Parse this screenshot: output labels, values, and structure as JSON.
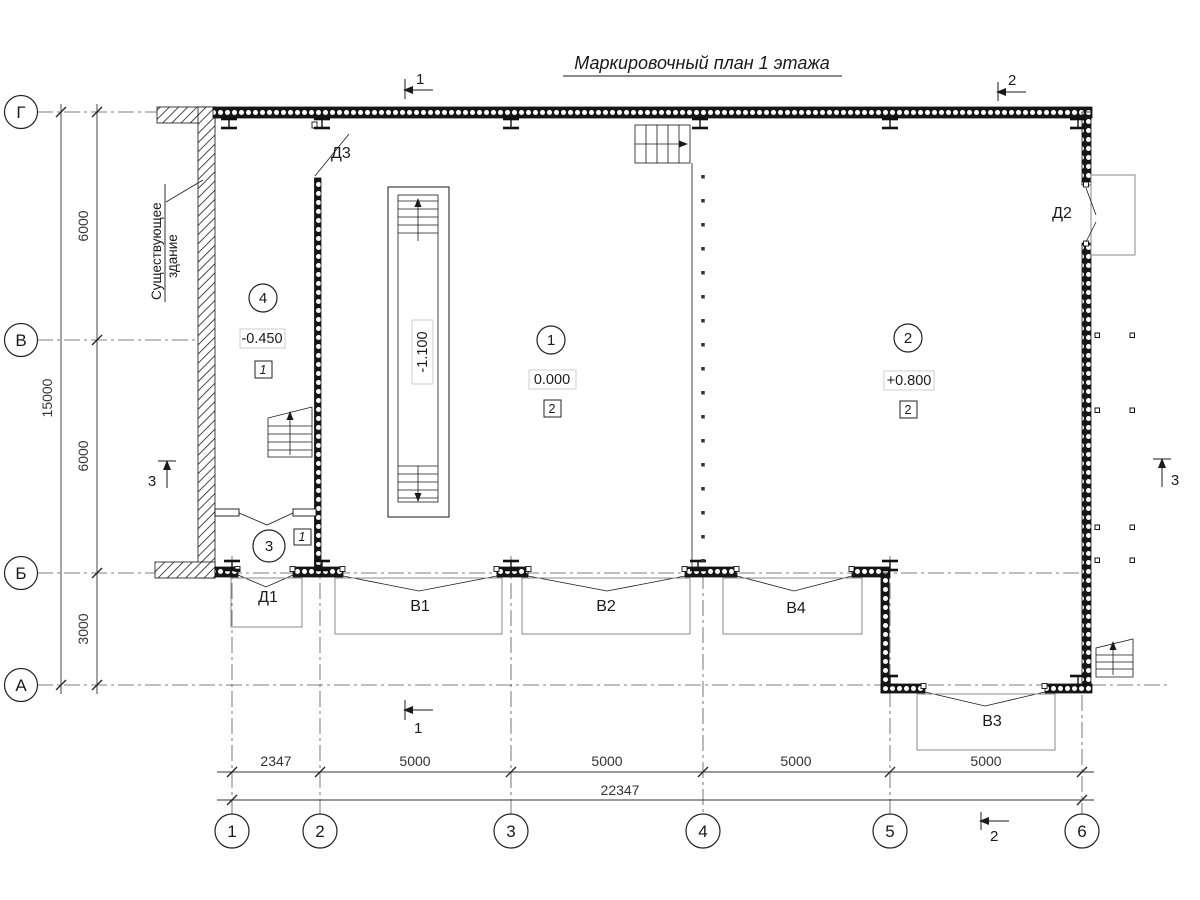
{
  "title": "Маркировочный план 1 этажа",
  "existing_building": {
    "line1": "Существующее",
    "line2": "здание"
  },
  "axes": {
    "rows": [
      {
        "label": "Г"
      },
      {
        "label": "В"
      },
      {
        "label": "Б"
      },
      {
        "label": "А"
      }
    ],
    "cols": [
      {
        "label": "1"
      },
      {
        "label": "2"
      },
      {
        "label": "3"
      },
      {
        "label": "4"
      },
      {
        "label": "5"
      },
      {
        "label": "6"
      }
    ]
  },
  "dimensions": {
    "left_segments": [
      {
        "value": "6000"
      },
      {
        "value": "6000"
      },
      {
        "value": "3000"
      }
    ],
    "left_total": "15000",
    "bottom_segments": [
      {
        "value": "2347"
      },
      {
        "value": "5000"
      },
      {
        "value": "5000"
      },
      {
        "value": "5000"
      },
      {
        "value": "5000"
      }
    ],
    "bottom_total": "22347"
  },
  "rooms": {
    "room1": {
      "number": "1",
      "elevation": "0.000",
      "finish_mark": "2"
    },
    "room2": {
      "number": "2",
      "elevation": "+0.800",
      "finish_mark": "2"
    },
    "room3": {
      "number": "3",
      "finish_mark": "1"
    },
    "room4": {
      "number": "4",
      "elevation": "-0.450",
      "finish_mark": "1"
    }
  },
  "stair_pit": {
    "elevation": "-1.100"
  },
  "openings": {
    "d1": "Д1",
    "d2": "Д2",
    "d3": "Д3",
    "v1": "В1",
    "v2": "В2",
    "v3": "В3",
    "v4": "В4"
  },
  "section_marks": {
    "s1": "1",
    "s2": "2",
    "s3": "3"
  },
  "colors": {
    "ink": "#1a1a1a",
    "muted": "#8a8a8a"
  }
}
